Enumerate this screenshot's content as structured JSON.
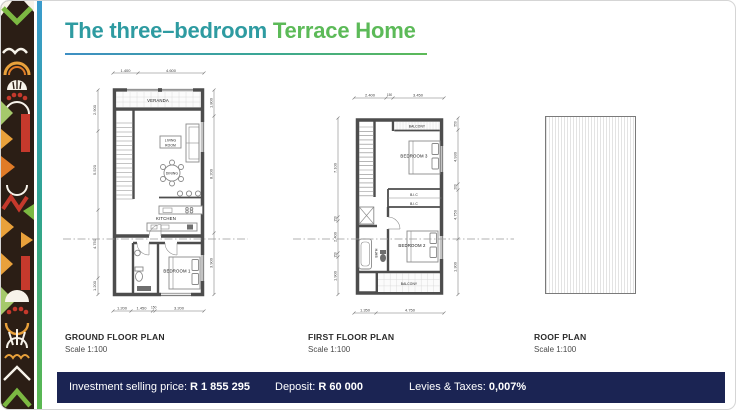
{
  "title": {
    "part1": "The three–bedroom",
    "part2": "Terrace Home"
  },
  "plans": {
    "ground": {
      "name": "GROUND FLOOR PLAN",
      "scale": "Scale 1:100",
      "rooms": {
        "veranda": "VERANDA",
        "living1": "LIVING",
        "living2": "ROOM",
        "dining": "DINING",
        "kitchen": "KITCHEN",
        "bedroom1": "BEDROOM 1"
      },
      "dims": {
        "top": [
          "1.400",
          "4.600"
        ],
        "left": [
          "2.900",
          "5.520",
          "4.750",
          "1.200"
        ],
        "right": [
          "1.800",
          "8.200",
          "3.900"
        ],
        "bottom": [
          "1.200",
          "1.450",
          "150",
          "3.200"
        ]
      }
    },
    "first": {
      "name": "FIRST FLOOR PLAN",
      "scale": "Scale 1:100",
      "rooms": {
        "balcony_top": "BALCONY",
        "bedroom3": "BEDROOM 3",
        "bic_top": "B.I.C",
        "bic_bottom": "B.I.C",
        "bath": "BATH",
        "bedroom2": "BEDROOM 2",
        "balcony_bottom": "BALCONY"
      },
      "dims": {
        "top": [
          "2.400",
          "150",
          "3.450"
        ],
        "left": [
          "7.100",
          "150",
          "2.400",
          "150",
          "1.900"
        ],
        "right": [
          "550",
          "4.930",
          "200",
          "4.750",
          "1.300"
        ],
        "bottom": [
          "1.350",
          "4.750"
        ]
      }
    },
    "roof": {
      "name": "ROOF PLAN",
      "scale": "Scale 1:100"
    }
  },
  "footer": {
    "price_label": "Investment selling price:",
    "price_value": "R 1 855 295",
    "deposit_label": "Deposit:",
    "deposit_value": "R 60 000",
    "levies_label": "Levies & Taxes:",
    "levies_value": "0,007%"
  },
  "colors": {
    "teal": "#2E9BA1",
    "green": "#5CBA58",
    "navy": "#1B2453",
    "pattern_brown": "#2B1E15",
    "pattern_red": "#C5392C",
    "pattern_yellow": "#E9A13B",
    "pattern_green": "#7CB942"
  }
}
